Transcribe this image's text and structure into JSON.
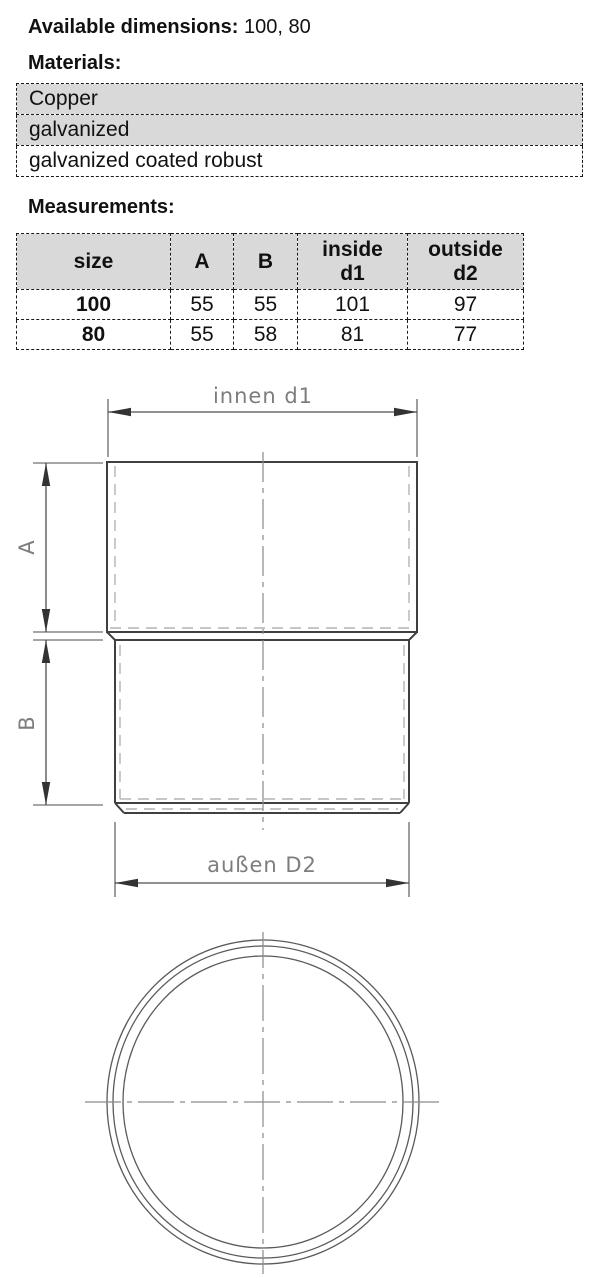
{
  "intro": {
    "label": "Available dimensions:",
    "value": "100, 80"
  },
  "sections": {
    "materials": "Materials:",
    "measurements": "Measurements:"
  },
  "materials_table": {
    "rows": [
      {
        "name": "Copper"
      },
      {
        "name": "galvanized"
      },
      {
        "name": "galvanized coated robust"
      }
    ]
  },
  "measurements_table": {
    "headers": {
      "size": "size",
      "a": "A",
      "b": "B",
      "inside_line1": "inside",
      "inside_line2": "d1",
      "outside_line1": "outside",
      "outside_line2": "d2"
    },
    "rows": [
      {
        "size": "100",
        "a": "55",
        "b": "55",
        "inside_d1": "101",
        "outside_d2": "97"
      },
      {
        "size": "80",
        "a": "55",
        "b": "58",
        "inside_d1": "81",
        "outside_d2": "77"
      }
    ]
  },
  "drawing": {
    "labels": {
      "inner_diameter": "innen d1",
      "outer_diameter": "außen D2",
      "height_a": "A",
      "height_b": "B"
    },
    "colors": {
      "outline": "#404040",
      "dimension": "#4d4d4d",
      "hidden_line": "#b3b3b3",
      "centerline": "#8a8a8a",
      "label_text": "#7d7d7d",
      "table_shade": "#d9d9d9"
    }
  }
}
